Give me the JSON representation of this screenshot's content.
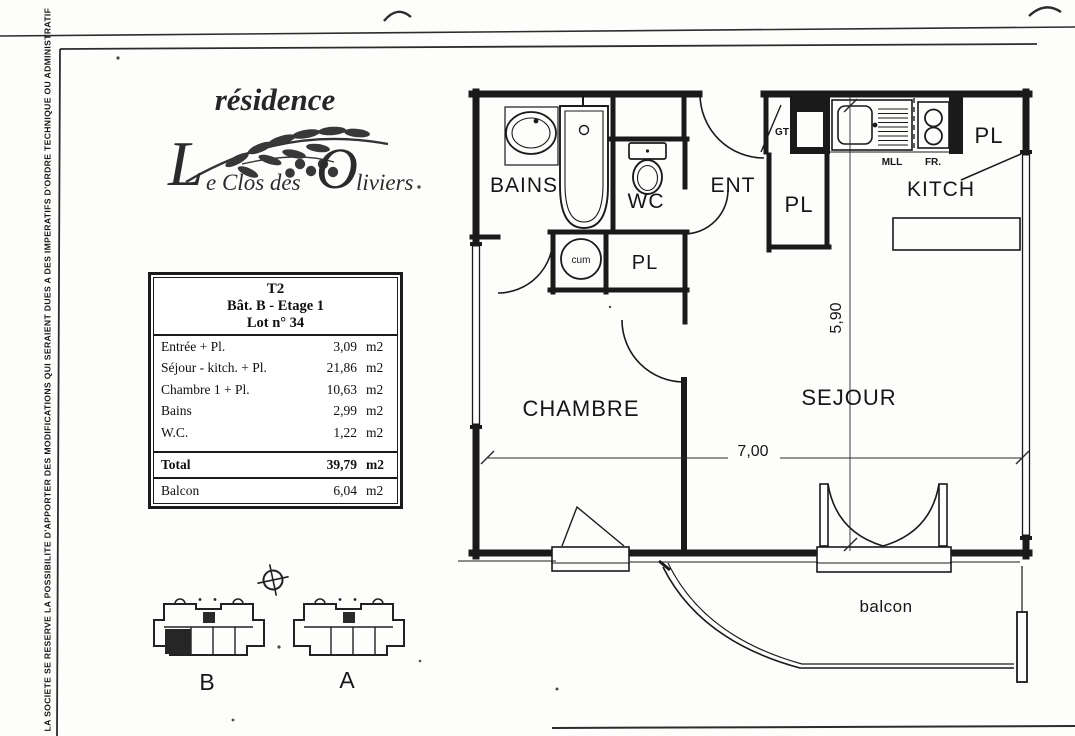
{
  "side_note": "LA SOCIETE SE RESERVE LA POSSIBILITE D'APPORTER DES MODIFICATIONS QUI SERAIENT DUES A DES IMPERATIFS D'ORDRE TECHNIQUE OU ADMINISTRATIF",
  "logo": {
    "brand": "résidence",
    "name_initial": "L",
    "name_mid": "e Clos des",
    "name_o": "O",
    "name_end": "liviers"
  },
  "info_table": {
    "line1": "T2",
    "line2": "Bât.  B - Etage 1",
    "line3": "Lot n° 34",
    "rows": [
      {
        "label": "Entrée + Pl.",
        "value": "3,09",
        "unit": "m2"
      },
      {
        "label": "Séjour - kitch. + Pl.",
        "value": "21,86",
        "unit": "m2"
      },
      {
        "label": "Chambre 1 + Pl.",
        "value": "10,63",
        "unit": "m2"
      },
      {
        "label": "Bains",
        "value": "2,99",
        "unit": "m2"
      },
      {
        "label": "W.C.",
        "value": "1,22",
        "unit": "m2"
      }
    ],
    "total_label": "Total",
    "total_value": "39,79",
    "total_unit": "m2",
    "balcony_label": "Balcon",
    "balcony_value": "6,04",
    "balcony_unit": "m2"
  },
  "plan": {
    "labels": {
      "bains": "BAINS",
      "wc": "WC",
      "ent": "ENT",
      "kitch": "KITCH",
      "chambre": "CHAMBRE",
      "sejour": "SEJOUR",
      "balcon": "balcon",
      "pl": "PL",
      "gt": "GT",
      "cum": "cum",
      "mll": "MLL",
      "fr": "FR."
    },
    "dims": {
      "width": "7,00",
      "height": "5,90"
    }
  },
  "buildings": {
    "b": "B",
    "a": "A"
  },
  "colors": {
    "ink": "#1a1a1a"
  }
}
